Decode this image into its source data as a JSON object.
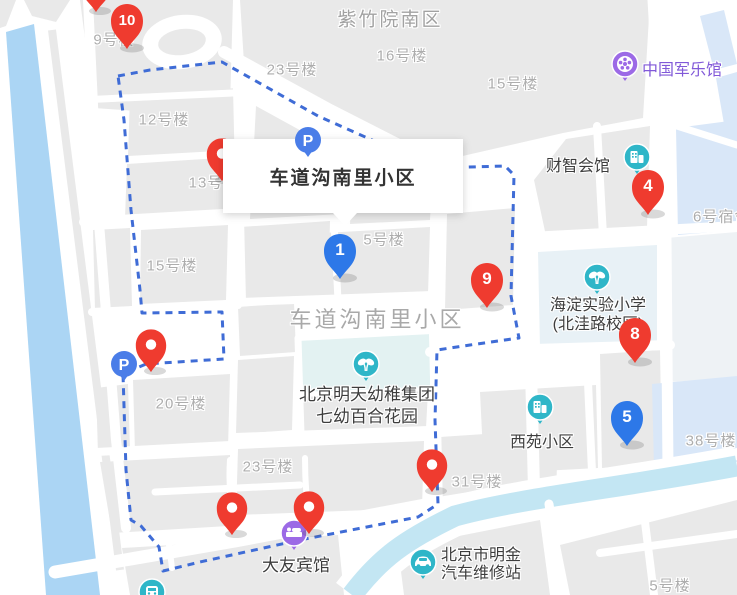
{
  "map": {
    "tooltip": {
      "title": "车道沟南里小区"
    },
    "area_labels": [
      {
        "text": "紫竹院南区"
      },
      {
        "text": "23号楼"
      },
      {
        "text": "16号楼"
      },
      {
        "text": "15号楼"
      },
      {
        "text": "9号楼"
      },
      {
        "text": "12号楼"
      },
      {
        "text": "13号楼"
      },
      {
        "text": "15号楼"
      },
      {
        "text": "5号楼"
      },
      {
        "text": "车道沟南里小区"
      },
      {
        "text": "20号楼"
      },
      {
        "text": "23号楼"
      },
      {
        "text": "31号楼"
      },
      {
        "text": "38号楼"
      },
      {
        "text": "6号宿舍"
      },
      {
        "text": "5号楼"
      }
    ],
    "pois": [
      {
        "name": "中国军乐馆",
        "icon": "music-hall-icon",
        "lines": [
          "中国军乐馆"
        ]
      },
      {
        "name": "财智会馆",
        "icon": "office-building-icon",
        "lines": [
          "财智会馆"
        ]
      },
      {
        "name": "海淀实验小学(北洼路校区)",
        "icon": "school-icon",
        "lines": [
          "海淀实验小学",
          "(北洼路校区)"
        ]
      },
      {
        "name": "北京明天幼稚集团七幼百合花园",
        "icon": "kindergarten-icon",
        "lines": [
          "北京明天幼稚集团",
          "七幼百合花园"
        ]
      },
      {
        "name": "西苑小区",
        "icon": "residential-icon",
        "lines": [
          "西苑小区"
        ]
      },
      {
        "name": "大友宾馆",
        "icon": "hotel-icon",
        "lines": [
          "大友宾馆"
        ]
      },
      {
        "name": "北京市明金汽车维修站",
        "icon": "car-repair-icon",
        "lines": [
          "北京市明金",
          "汽车维修站"
        ]
      }
    ],
    "parking": {
      "label": "P"
    },
    "markers": {
      "numbered": [
        {
          "label": "10",
          "color": "red"
        },
        {
          "label": "1",
          "color": "blue"
        },
        {
          "label": "9",
          "color": "red"
        },
        {
          "label": "4",
          "color": "red"
        },
        {
          "label": "8",
          "color": "red"
        },
        {
          "label": "5",
          "color": "blue"
        }
      ],
      "plain_red_pins": 6
    },
    "colors": {
      "marker_red": "#ef3b2f",
      "marker_blue": "#2d78e8",
      "parking_blue": "#4a7de8",
      "poi_teal": "#2fb6c8",
      "poi_purple": "#9c6ae6",
      "purple_text": "#8159d8",
      "boundary_blue": "#3f6cd6",
      "water": "#abd5f4",
      "river": "#c3e6f3",
      "building_blue": "#d9e7f8",
      "block_gray": "#e9e9e9"
    }
  }
}
